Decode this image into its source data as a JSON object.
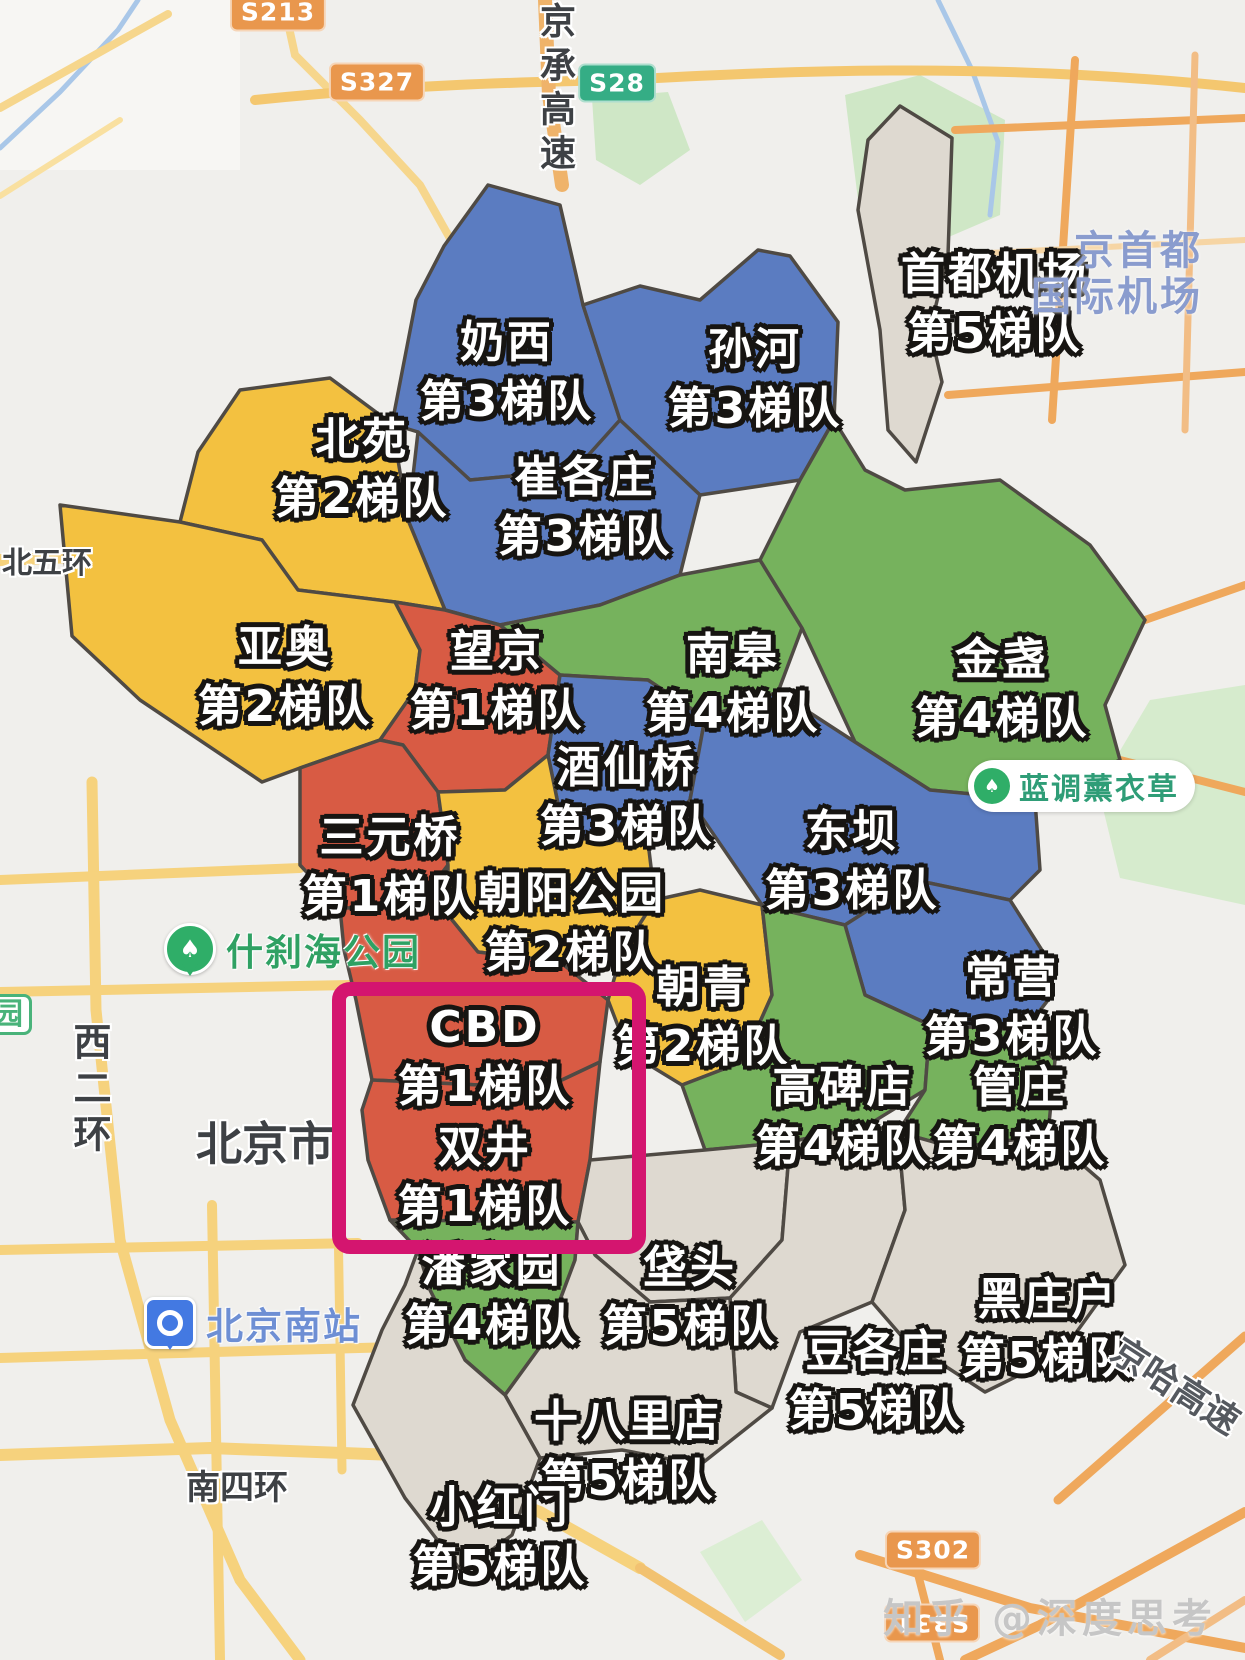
{
  "map": {
    "background_color": "#f0efec",
    "tier_colors": {
      "1": "#d85b44",
      "2": "#f3c140",
      "3": "#5b7cc1",
      "4": "#76b25d",
      "5": "#ded9d0"
    },
    "regions": [
      {
        "id": "shoudu-jichang",
        "name": "首都机场",
        "tier": "第5梯队",
        "t": "5",
        "x": 995,
        "y": 305
      },
      {
        "id": "naixi",
        "name": "奶西",
        "tier": "第3梯队",
        "t": "3",
        "x": 507,
        "y": 373
      },
      {
        "id": "sunhe",
        "name": "孙河",
        "tier": "第3梯队",
        "t": "3",
        "x": 755,
        "y": 380
      },
      {
        "id": "beiyuan",
        "name": "北苑",
        "tier": "第2梯队",
        "t": "2",
        "x": 362,
        "y": 470
      },
      {
        "id": "cuigezhuang",
        "name": "崔各庄",
        "tier": "第3梯队",
        "t": "3",
        "x": 585,
        "y": 508
      },
      {
        "id": "yaao",
        "name": "亚奥",
        "tier": "第2梯队",
        "t": "2",
        "x": 285,
        "y": 678
      },
      {
        "id": "wangjing",
        "name": "望京",
        "tier": "第1梯队",
        "t": "1",
        "x": 497,
        "y": 682
      },
      {
        "id": "nangao",
        "name": "南皋",
        "tier": "第4梯队",
        "t": "4",
        "x": 733,
        "y": 685
      },
      {
        "id": "jinzhan",
        "name": "金盏",
        "tier": "第4梯队",
        "t": "4",
        "x": 1002,
        "y": 690
      },
      {
        "id": "jiuxianqiao",
        "name": "酒仙桥",
        "tier": "第3梯队",
        "t": "3",
        "x": 627,
        "y": 798
      },
      {
        "id": "dongba",
        "name": "东坝",
        "tier": "第3梯队",
        "t": "3",
        "x": 852,
        "y": 862
      },
      {
        "id": "sanyuanqiao",
        "name": "三元桥",
        "tier": "第1梯队",
        "t": "1",
        "x": 390,
        "y": 868
      },
      {
        "id": "chaoyang-gongyuan",
        "name": "朝阳公园",
        "tier": "第2梯队",
        "t": "2",
        "x": 572,
        "y": 924
      },
      {
        "id": "chaoqing",
        "name": "朝青",
        "tier": "第2梯队",
        "t": "2",
        "x": 703,
        "y": 1018
      },
      {
        "id": "changying",
        "name": "常营",
        "tier": "第3梯队",
        "t": "3",
        "x": 1012,
        "y": 1008
      },
      {
        "id": "cbd",
        "name": "CBD",
        "tier": "第1梯队",
        "t": "1",
        "x": 485,
        "y": 1058
      },
      {
        "id": "shuangjing",
        "name": "双井",
        "tier": "第1梯队",
        "t": "1",
        "x": 485,
        "y": 1178
      },
      {
        "id": "gaobeidian",
        "name": "高碑店",
        "tier": "第4梯队",
        "t": "4",
        "x": 843,
        "y": 1118
      },
      {
        "id": "guanzhuang",
        "name": "管庄",
        "tier": "第4梯队",
        "t": "4",
        "x": 1020,
        "y": 1118
      },
      {
        "id": "panjiayuan",
        "name": "潘家园",
        "tier": "第4梯队",
        "t": "4",
        "x": 492,
        "y": 1297
      },
      {
        "id": "fatou",
        "name": "垡头",
        "tier": "第5梯队",
        "t": "5",
        "x": 690,
        "y": 1298
      },
      {
        "id": "dougezhuang",
        "name": "豆各庄",
        "tier": "第5梯队",
        "t": "5",
        "x": 876,
        "y": 1382
      },
      {
        "id": "heizhuanghu",
        "name": "黑庄户",
        "tier": "第5梯队",
        "t": "5",
        "x": 1048,
        "y": 1330
      },
      {
        "id": "shibalidian",
        "name": "十八里店",
        "tier": "第5梯队",
        "t": "5",
        "x": 628,
        "y": 1452
      },
      {
        "id": "xiaohongmen",
        "name": "小红门",
        "tier": "第5梯队",
        "t": "5",
        "x": 500,
        "y": 1538
      }
    ],
    "highlight_box": {
      "color": "#d4156f",
      "x": 332,
      "y": 982,
      "w": 314,
      "h": 272
    },
    "route_badges": [
      {
        "text": "S213",
        "x": 278,
        "y": 12,
        "bg": "#e9974d",
        "rotate": 0
      },
      {
        "text": "S327",
        "x": 377,
        "y": 82,
        "bg": "#e9974d",
        "rotate": 0
      },
      {
        "text": "S28",
        "x": 617,
        "y": 83,
        "bg": "#35ad85",
        "rotate": 0
      },
      {
        "text": "S302",
        "x": 933,
        "y": 1550,
        "bg": "#e9974d",
        "rotate": 0
      },
      {
        "text": "S331",
        "x": 932,
        "y": 1623,
        "bg": "#e9974d",
        "rotate": 180
      }
    ],
    "road_labels": [
      {
        "text": "北五环",
        "x": 2,
        "y": 538,
        "size": 30,
        "mode": "h"
      },
      {
        "text": "西二环",
        "x": 62,
        "y": 1022,
        "size": 38,
        "mode": "v"
      },
      {
        "text": "北京市",
        "x": 196,
        "y": 1108,
        "size": 46,
        "mode": "h"
      },
      {
        "text": "南四环",
        "x": 186,
        "y": 1460,
        "size": 34,
        "mode": "h"
      },
      {
        "text": "京承高速",
        "x": 528,
        "y": 2,
        "size": 36,
        "mode": "v"
      },
      {
        "text": "京哈高速",
        "x": 1105,
        "y": 1358,
        "size": 36,
        "mode": "r33"
      }
    ],
    "pois": [
      {
        "id": "shichahai-park",
        "type": "park",
        "text": "什刹海公园",
        "x": 164,
        "y": 922,
        "color": "#2fa163",
        "size": 37
      },
      {
        "id": "lavender-garden",
        "type": "pill",
        "text": "蓝调薰衣草",
        "x": 968,
        "y": 760,
        "color": "#2f9d77",
        "size": 30
      },
      {
        "id": "beijing-south-station",
        "type": "rail",
        "text": "北京南站",
        "x": 144,
        "y": 1296,
        "color": "#6e8fd4",
        "size": 37
      },
      {
        "id": "capital-airport-label",
        "type": "air",
        "lines": [
          "京首都",
          "国际机场"
        ],
        "right": 42,
        "y": 228
      },
      {
        "id": "cutoff-park-label",
        "type": "yuan",
        "text": "园",
        "x": -16,
        "y": 994
      }
    ],
    "watermark": {
      "text": "知乎 @深度思考"
    }
  }
}
